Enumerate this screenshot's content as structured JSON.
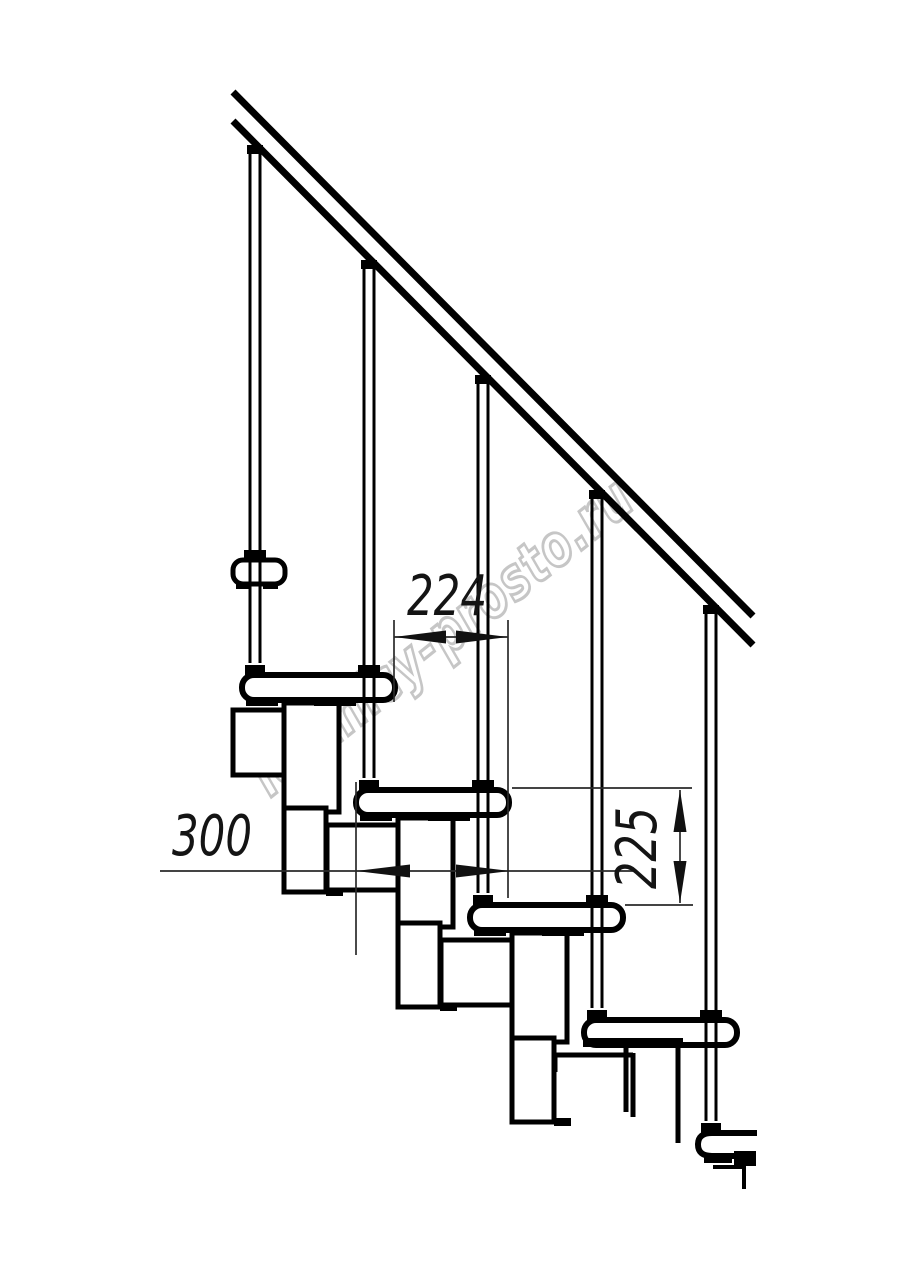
{
  "document": {
    "type": "technical line drawing",
    "subject": "modular staircase side elevation",
    "background": "#ffffff",
    "line_color": "#000000",
    "dim_line_color": "#2a2a2a"
  },
  "watermark": {
    "text": "lestnicy-prosto.ru",
    "color": "#bdbdbd"
  },
  "dimensions": {
    "step_run": {
      "value": "224"
    },
    "tread_depth": {
      "value": "300"
    },
    "riser_height": {
      "value": "225"
    }
  },
  "structure": {
    "treads_visible": "5",
    "balusters_visible": "5"
  }
}
